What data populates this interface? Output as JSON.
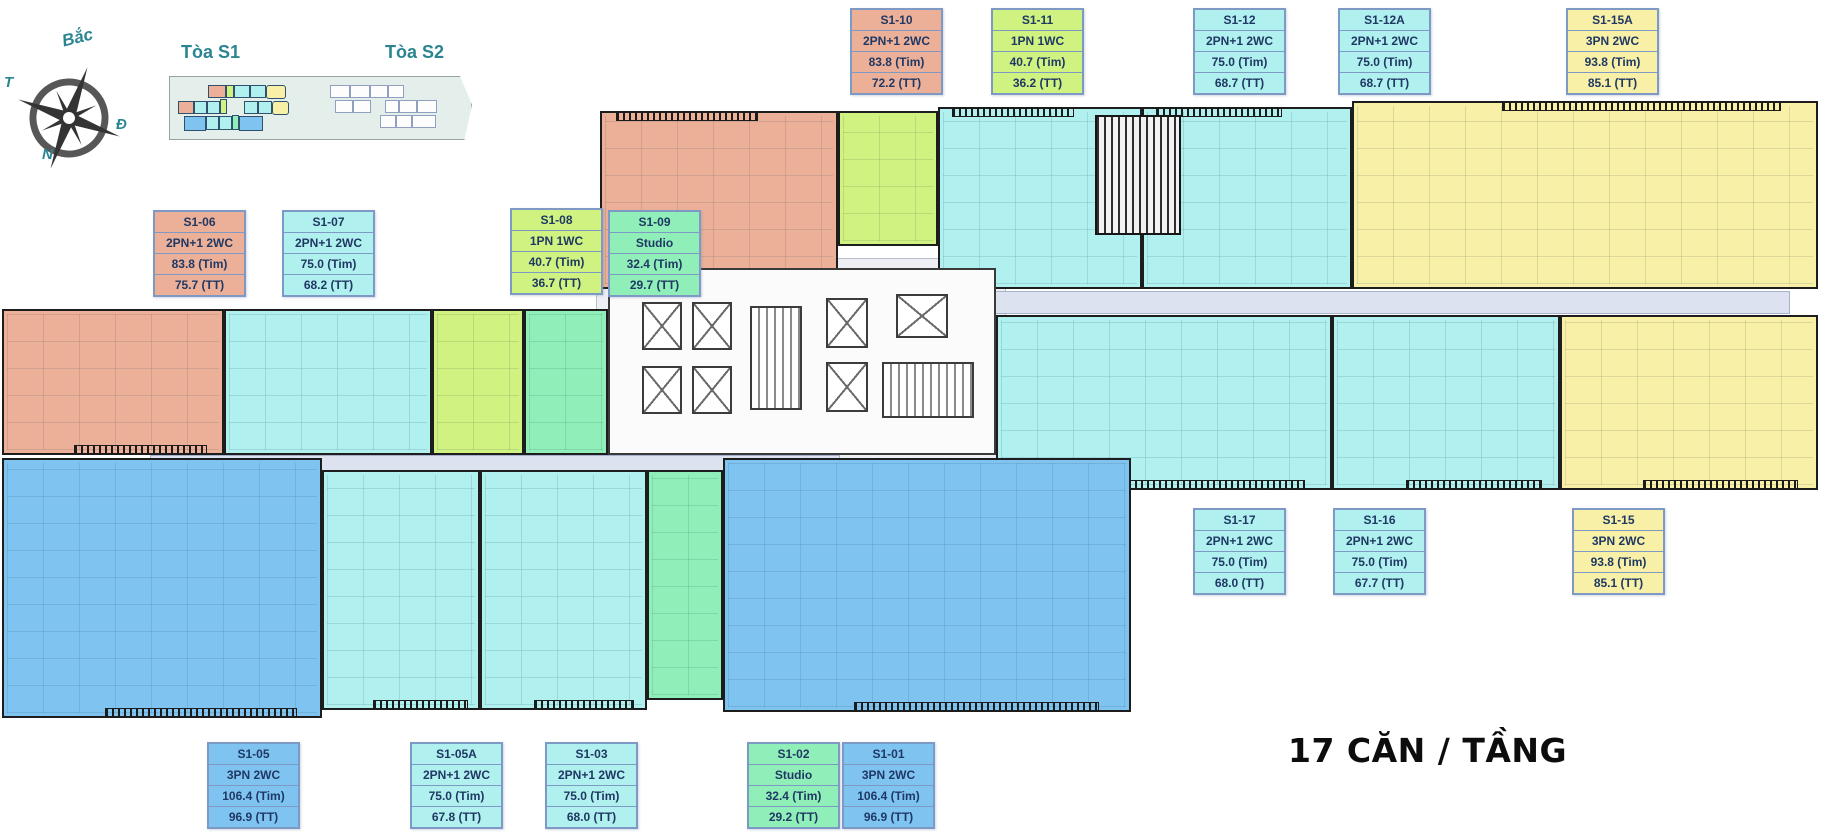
{
  "palette": {
    "salmon": "#ECB098",
    "lime": "#CFF280",
    "cyan": "#B0F0EE",
    "green": "#90EFB8",
    "yellow": "#F8F0A6",
    "blue": "#7FC3F1",
    "card_border": "#7E99C4",
    "text_navy": "#1F3864",
    "teal": "#2A8591",
    "corridor": "#DDE2F0"
  },
  "compass": {
    "north_label": "Bắc",
    "west_label": "T",
    "east_label": "Đ",
    "south_label": "N"
  },
  "minimap": {
    "tower1_label": "Tòa S1",
    "tower2_label": "Tòa S2"
  },
  "footer": {
    "units_per_floor": "17 CĂN / TẦNG"
  },
  "units": [
    {
      "label": "S1-10",
      "type": "2PN+1 2WC",
      "tim": "83.8 (Tim)",
      "tt": "72.2 (TT)",
      "color": "salmon"
    },
    {
      "label": "S1-11",
      "type": "1PN 1WC",
      "tim": "40.7 (Tim)",
      "tt": "36.2 (TT)",
      "color": "lime"
    },
    {
      "label": "S1-12",
      "type": "2PN+1 2WC",
      "tim": "75.0 (Tim)",
      "tt": "68.7 (TT)",
      "color": "cyan"
    },
    {
      "label": "S1-12A",
      "type": "2PN+1 2WC",
      "tim": "75.0 (Tim)",
      "tt": "68.7 (TT)",
      "color": "cyan"
    },
    {
      "label": "S1-15A",
      "type": "3PN 2WC",
      "tim": "93.8 (Tim)",
      "tt": "85.1 (TT)",
      "color": "yellow"
    },
    {
      "label": "S1-06",
      "type": "2PN+1 2WC",
      "tim": "83.8 (Tim)",
      "tt": "75.7 (TT)",
      "color": "salmon"
    },
    {
      "label": "S1-07",
      "type": "2PN+1 2WC",
      "tim": "75.0 (Tim)",
      "tt": "68.2 (TT)",
      "color": "cyan"
    },
    {
      "label": "S1-08",
      "type": "1PN 1WC",
      "tim": "40.7 (Tim)",
      "tt": "36.7 (TT)",
      "color": "lime"
    },
    {
      "label": "S1-09",
      "type": "Studio",
      "tim": "32.4 (Tim)",
      "tt": "29.7 (TT)",
      "color": "green"
    },
    {
      "label": "S1-17",
      "type": "2PN+1 2WC",
      "tim": "75.0 (Tim)",
      "tt": "68.0 (TT)",
      "color": "cyan"
    },
    {
      "label": "S1-16",
      "type": "2PN+1 2WC",
      "tim": "75.0 (Tim)",
      "tt": "67.7 (TT)",
      "color": "cyan"
    },
    {
      "label": "S1-15",
      "type": "3PN 2WC",
      "tim": "93.8 (Tim)",
      "tt": "85.1 (TT)",
      "color": "yellow"
    },
    {
      "label": "S1-05",
      "type": "3PN 2WC",
      "tim": "106.4 (Tim)",
      "tt": "96.9 (TT)",
      "color": "blue"
    },
    {
      "label": "S1-05A",
      "type": "2PN+1 2WC",
      "tim": "75.0 (Tim)",
      "tt": "67.8 (TT)",
      "color": "cyan"
    },
    {
      "label": "S1-03",
      "type": "2PN+1 2WC",
      "tim": "75.0 (Tim)",
      "tt": "68.0 (TT)",
      "color": "cyan"
    },
    {
      "label": "S1-02",
      "type": "Studio",
      "tim": "32.4 (Tim)",
      "tt": "29.2 (TT)",
      "color": "green"
    },
    {
      "label": "S1-01",
      "type": "3PN 2WC",
      "tim": "106.4 (Tim)",
      "tt": "96.9 (TT)",
      "color": "blue"
    }
  ]
}
